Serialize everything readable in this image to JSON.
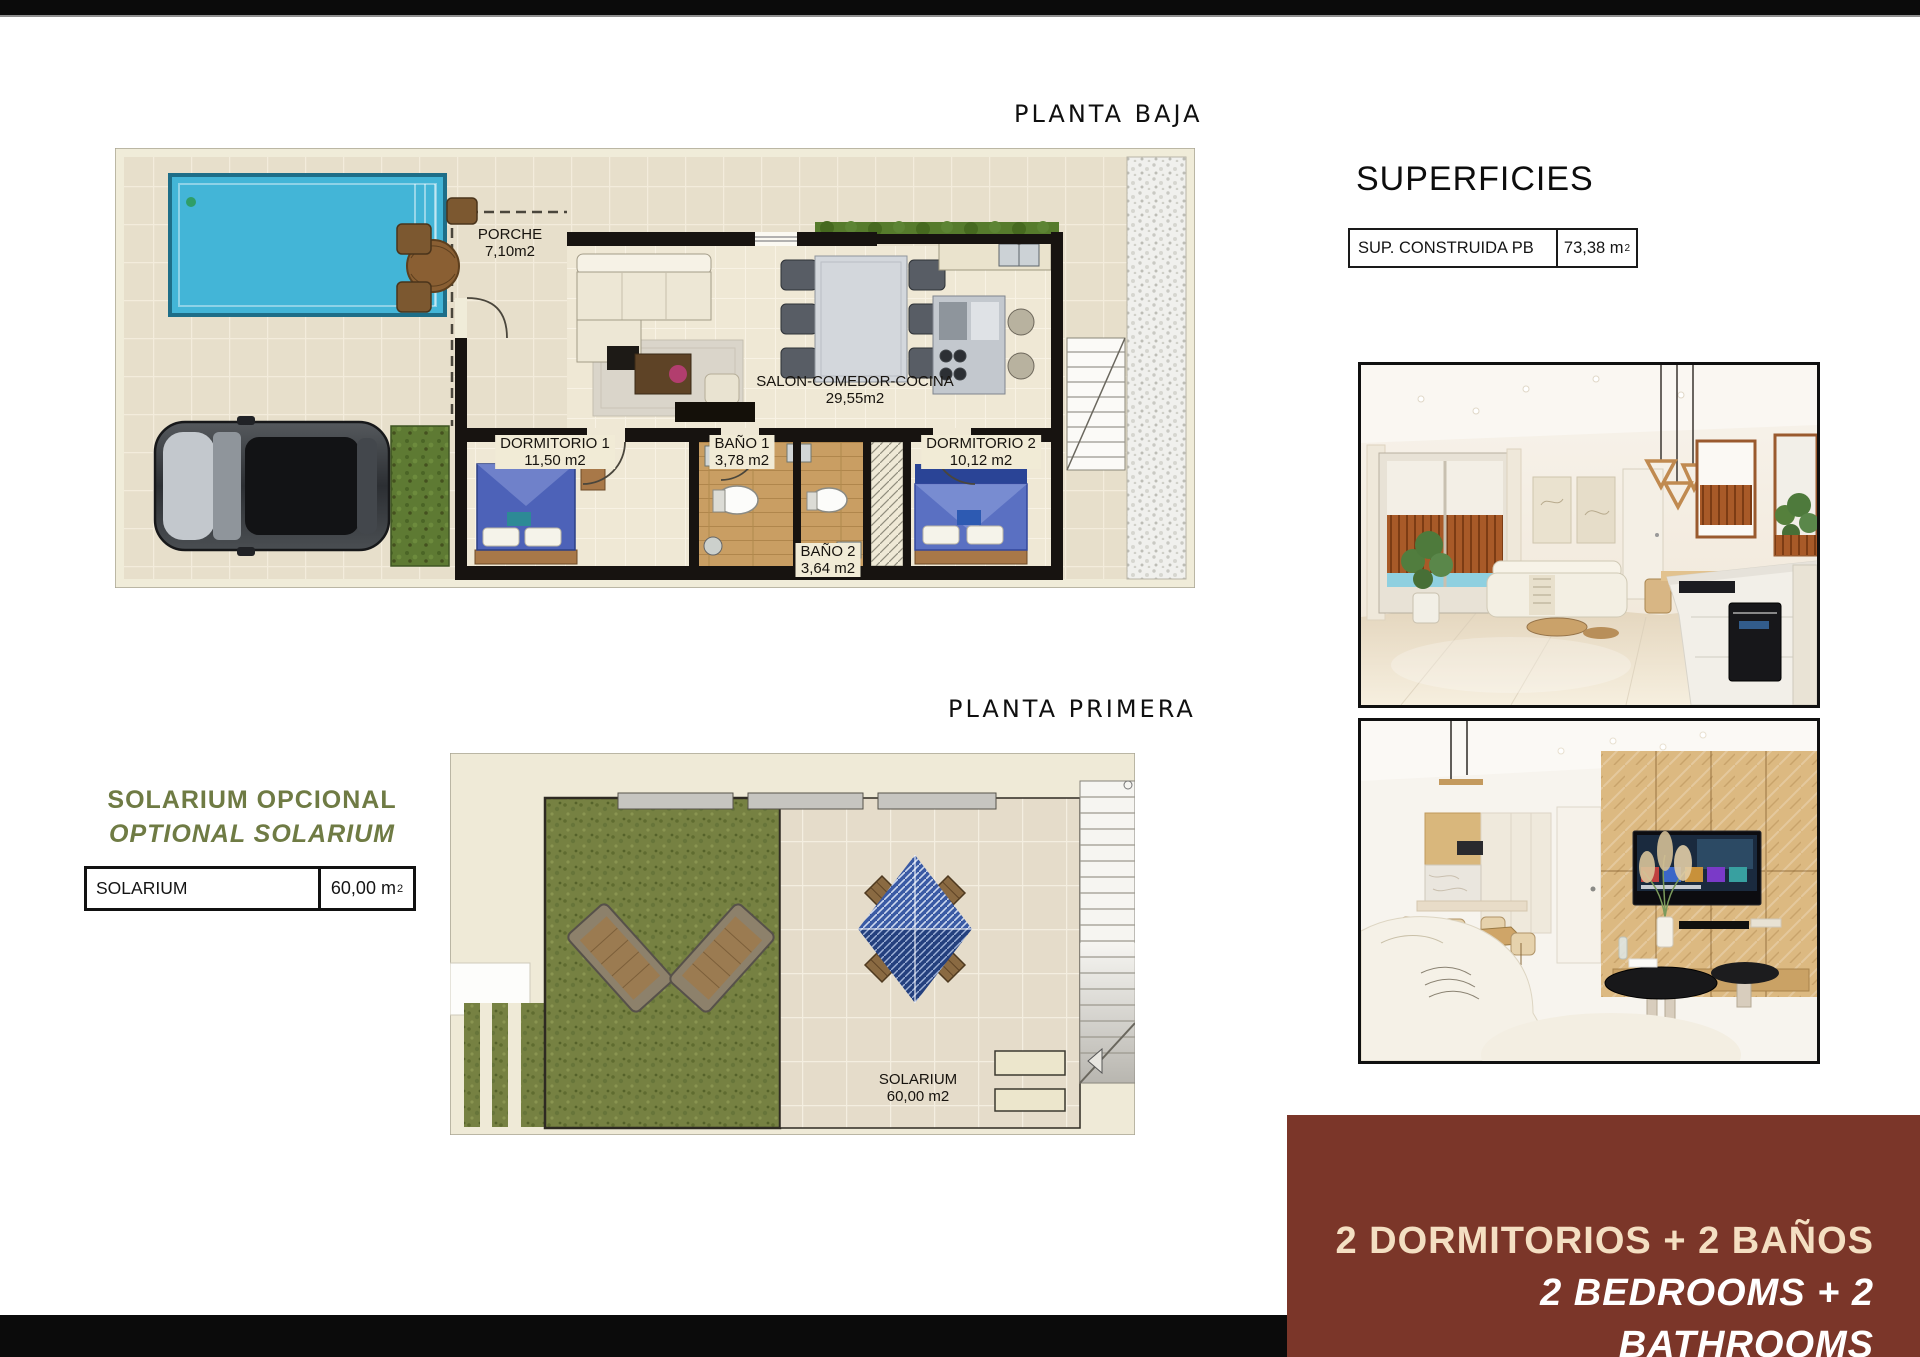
{
  "titles": {
    "ground_floor": "PLANTA BAJA",
    "first_floor": "PLANTA PRIMERA",
    "surfaces": "SUPERFICIES"
  },
  "surfaces_table": {
    "label": "SUP. CONSTRUIDA PB",
    "value": "73,38",
    "unit": "m",
    "unit_exp": "2"
  },
  "solarium_heading": {
    "line1": "SOLARIUM OPCIONAL",
    "line2": "OPTIONAL SOLARIUM"
  },
  "solarium_table": {
    "label": "SOLARIUM",
    "value": "60,00",
    "unit": "m",
    "unit_exp": "2"
  },
  "ground_plan": {
    "rooms": [
      {
        "name": "PORCHE",
        "area": "7,10m2"
      },
      {
        "name": "SALON-COMEDOR-COCINA",
        "area": "29,55m2"
      },
      {
        "name": "DORMITORIO 1",
        "area": "11,50 m2"
      },
      {
        "name": "BAÑO 1",
        "area": "3,78 m2"
      },
      {
        "name": "BAÑO 2",
        "area": "3,64 m2"
      },
      {
        "name": "DORMITORIO 2",
        "area": "10,12 m2"
      }
    ]
  },
  "first_floor_plan": {
    "room": {
      "name": "SOLARIUM",
      "area": "60,00 m2"
    }
  },
  "banner": {
    "line1": "2 DORMITORIOS + 2 BAÑOS",
    "line2": "2 BEDROOMS + 2 BATHROOMS"
  },
  "colors": {
    "banner_bg": "#7b3629",
    "olive_text": "#6f7b44",
    "pool_blue": "#43b5d7",
    "grass_green": "#768142",
    "top_bar": "#0b0b0b"
  }
}
